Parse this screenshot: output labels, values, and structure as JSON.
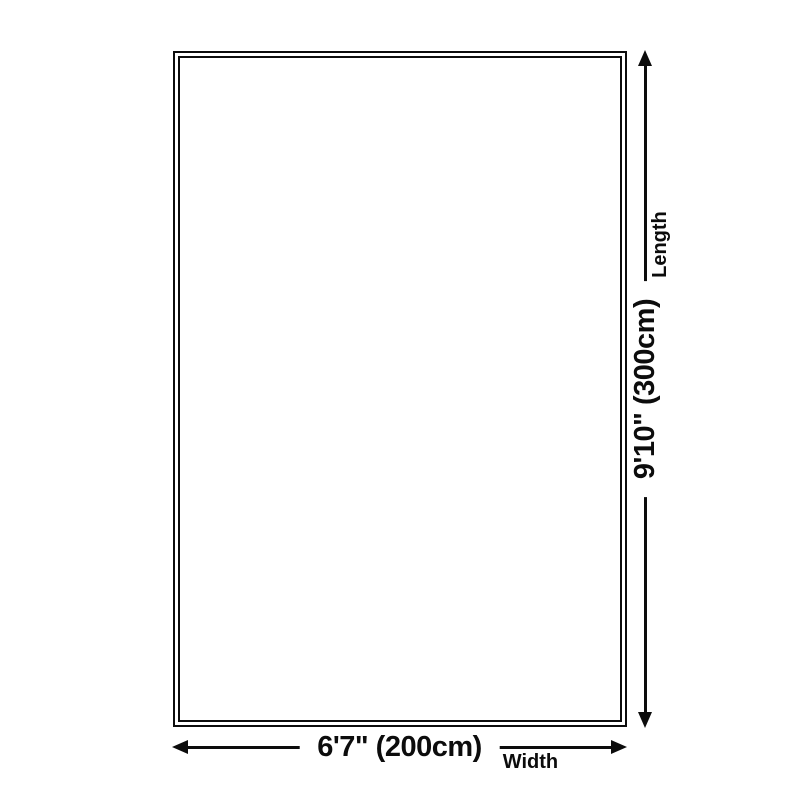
{
  "diagram": {
    "title": "rug-size-dimension-diagram",
    "rug": {
      "shape": "rectangle",
      "border_style": "double"
    },
    "width_dimension": {
      "value": "6'7\" (200cm)",
      "label": "Width",
      "icon": "double-headed-horizontal-arrow"
    },
    "length_dimension": {
      "value": "9'10\" (300cm)",
      "label": "Length",
      "icon": "double-headed-vertical-arrow"
    },
    "colors": {
      "line": "#0c0c0c",
      "text": "#0c0c0c",
      "background": "#ffffff"
    }
  }
}
